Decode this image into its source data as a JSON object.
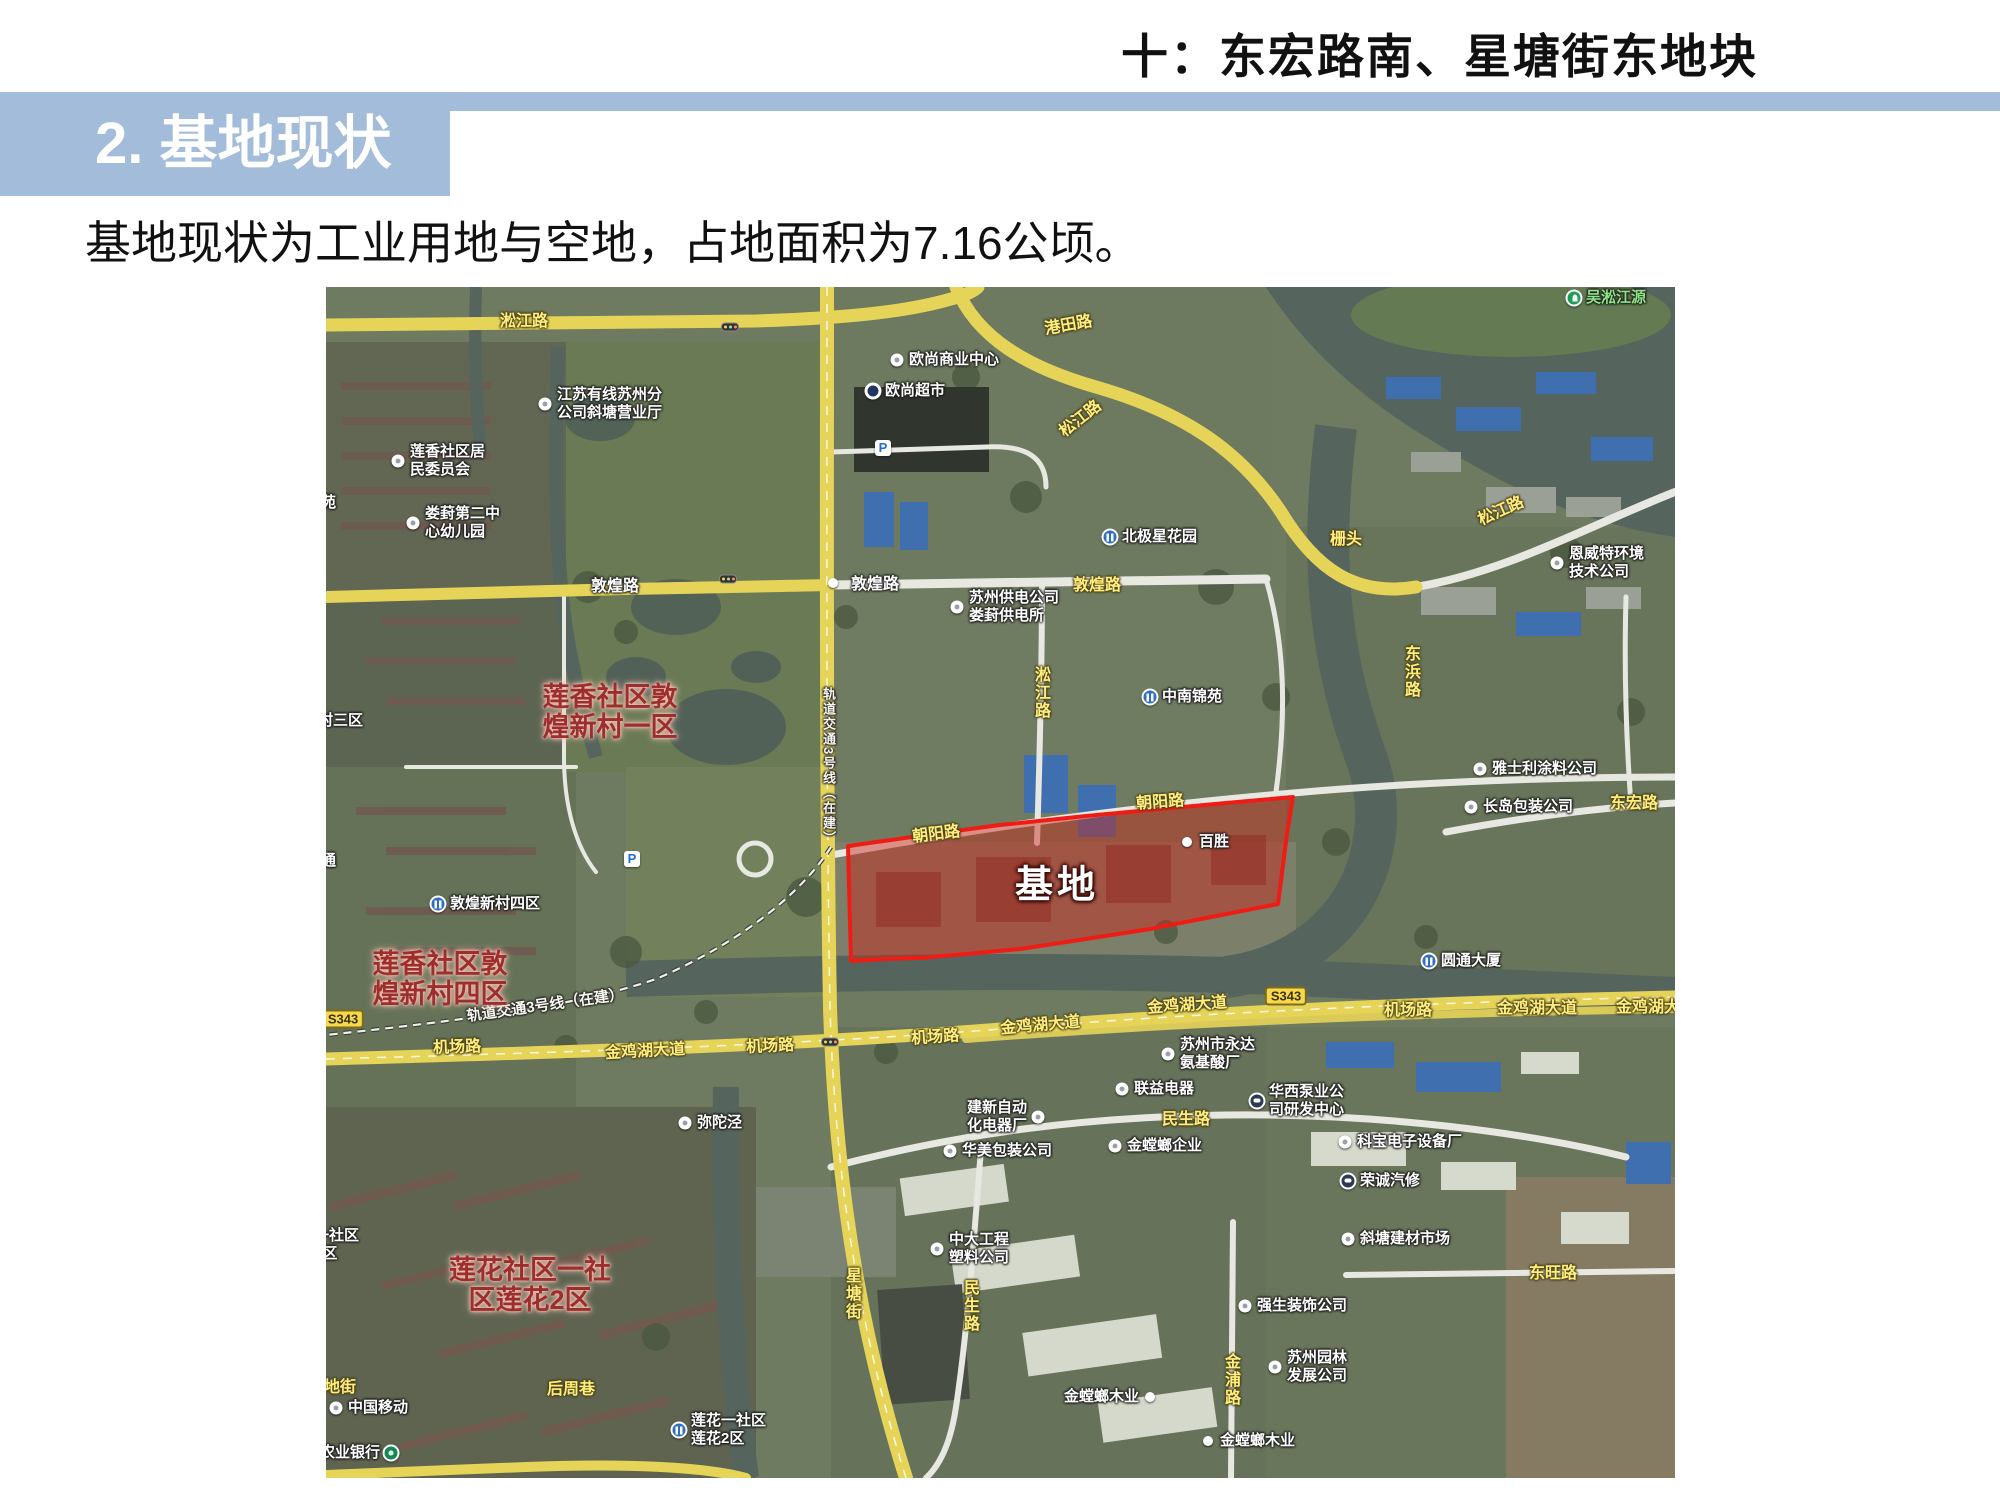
{
  "page": {
    "header_title": "十：东宏路南、星塘街东地块",
    "section_title": "2. 基地现状",
    "body_text": "基地现状为工业用地与空地，占地面积为7.16公顷。"
  },
  "colors": {
    "header_blue": "#a2bcd9",
    "site_outline_red": "#ee1c14",
    "site_fill_red": "rgba(205,35,25,0.45)",
    "road_yellow": "#e6d459",
    "label_yellow": "#ffee7d",
    "water": "#55645c",
    "land": "#6e7b60"
  },
  "map": {
    "site_label": {
      "text": "基地",
      "x": 731,
      "y": 594
    },
    "area_labels": [
      {
        "lines": [
          "莲香社区敦",
          "煌新村一区"
        ],
        "x": 284,
        "y": 425
      },
      {
        "lines": [
          "莲香社区敦",
          "煌新村四区"
        ],
        "x": 114,
        "y": 692
      },
      {
        "lines": [
          "莲花社区一社",
          "区莲花2区"
        ],
        "x": 204,
        "y": 998
      }
    ],
    "road_labels": [
      {
        "text": "淞江路",
        "x": 198,
        "y": 32,
        "style": "yellow",
        "rot": 0
      },
      {
        "text": "港田路",
        "x": 742,
        "y": 36,
        "style": "yellow",
        "rot": -10
      },
      {
        "text": "松江路",
        "x": 753,
        "y": 130,
        "style": "yellow",
        "rot": -38
      },
      {
        "text": "松江路",
        "x": 1174,
        "y": 222,
        "style": "yellow",
        "rot": -24
      },
      {
        "text": "淞江路",
        "x": 714,
        "y": 406,
        "style": "yellow",
        "vertical": true
      },
      {
        "text": "东浜路",
        "x": 1084,
        "y": 385,
        "style": "yellow",
        "vertical": true
      },
      {
        "text": "敦煌路",
        "x": 289,
        "y": 297,
        "style": "white",
        "rot": 0
      },
      {
        "text": "敦煌路",
        "x": 549,
        "y": 295,
        "style": "white",
        "rot": 0
      },
      {
        "text": "敦煌路",
        "x": 771,
        "y": 296,
        "style": "yellow",
        "rot": 0
      },
      {
        "text": "朝阳路",
        "x": 610,
        "y": 545,
        "style": "yellow",
        "rot": -7
      },
      {
        "text": "朝阳路",
        "x": 834,
        "y": 513,
        "style": "yellow",
        "rot": -4
      },
      {
        "text": "东宏路",
        "x": 1308,
        "y": 514,
        "style": "yellow",
        "rot": 0
      },
      {
        "text": "民生路",
        "x": 860,
        "y": 830,
        "style": "yellow",
        "rot": 0
      },
      {
        "text": "民生路",
        "x": 643,
        "y": 1019,
        "style": "yellow",
        "vertical": true
      },
      {
        "text": "金浦路",
        "x": 904,
        "y": 1093,
        "style": "yellow",
        "vertical": true
      },
      {
        "text": "星塘街",
        "x": 525,
        "y": 1007,
        "style": "yellow",
        "vertical": true
      },
      {
        "text": "东旺路",
        "x": 1227,
        "y": 984,
        "style": "yellow",
        "rot": 0
      },
      {
        "text": "机场路",
        "x": 131,
        "y": 758,
        "style": "yellow",
        "rot": -2
      },
      {
        "text": "金鸡湖大道",
        "x": 319,
        "y": 762,
        "style": "yellow",
        "rot": -3
      },
      {
        "text": "机场路",
        "x": 444,
        "y": 757,
        "style": "yellow",
        "rot": -3
      },
      {
        "text": "机场路",
        "x": 609,
        "y": 748,
        "style": "yellow",
        "rot": -4
      },
      {
        "text": "金鸡湖大道",
        "x": 714,
        "y": 736,
        "style": "yellow",
        "rot": -5
      },
      {
        "text": "金鸡湖大道",
        "x": 861,
        "y": 716,
        "style": "yellow",
        "rot": -4
      },
      {
        "text": "机场路",
        "x": 1082,
        "y": 721,
        "style": "yellow",
        "rot": 0
      },
      {
        "text": "金鸡湖大道",
        "x": 1211,
        "y": 719,
        "style": "yellow",
        "rot": 0
      },
      {
        "text": "金鸡湖大道",
        "x": 1330,
        "y": 718,
        "style": "yellow",
        "rot": 0
      },
      {
        "text": "后周巷",
        "x": 245,
        "y": 1100,
        "style": "yellow",
        "rot": 0
      },
      {
        "text": "地街",
        "x": 14,
        "y": 1098,
        "style": "yellow",
        "rot": 0
      },
      {
        "text": "栅头",
        "x": 1020,
        "y": 250,
        "style": "yellow",
        "rot": 0
      }
    ],
    "shields": [
      {
        "text": "S343",
        "x": 17,
        "y": 732
      },
      {
        "text": "S343",
        "x": 960,
        "y": 709
      }
    ],
    "metro_labels": [
      {
        "text": "轨道交通3号线（在建）",
        "x": 250,
        "y": 716,
        "rot": -8,
        "vertical": false
      },
      {
        "text": "轨道交通3号线（在建）",
        "x": 501,
        "y": 490,
        "rot": 0,
        "vertical": true
      }
    ],
    "poi_labels": [
      {
        "lines": [
          "江苏有线苏州分",
          "公司斜塘营业厅"
        ],
        "x": 219,
        "y": 117,
        "icon": "dot"
      },
      {
        "lines": [
          "莲香社区居",
          "民委员会"
        ],
        "x": 72,
        "y": 174,
        "icon": "dot"
      },
      {
        "lines": [
          "娄葑第二中",
          "心幼儿园"
        ],
        "x": 87,
        "y": 236,
        "icon": "dot"
      },
      {
        "lines": [
          "欧尚商业中心"
        ],
        "x": 571,
        "y": 73,
        "icon": "dot"
      },
      {
        "lines": [
          "欧尚超市"
        ],
        "x": 547,
        "y": 104,
        "icon": "auchan"
      },
      {
        "lines": [
          "吴淞江源"
        ],
        "x": 1248,
        "y": 11,
        "icon": "park",
        "green": true
      },
      {
        "lines": [
          "恩威特环境",
          "技术公司"
        ],
        "x": 1231,
        "y": 276,
        "icon": "dot"
      },
      {
        "lines": [
          "北极星花园"
        ],
        "x": 784,
        "y": 250,
        "icon": "building"
      },
      {
        "lines": [
          "中南锦苑"
        ],
        "x": 824,
        "y": 410,
        "icon": "building"
      },
      {
        "lines": [
          "苏州供电公司",
          "娄葑供电所"
        ],
        "x": 631,
        "y": 320,
        "icon": "dot"
      },
      {
        "lines": [
          "百胜"
        ],
        "x": 861,
        "y": 555,
        "icon": "smalldot"
      },
      {
        "lines": [
          "雅士利涂料公司"
        ],
        "x": 1154,
        "y": 482,
        "icon": "dot"
      },
      {
        "lines": [
          "长岛包装公司"
        ],
        "x": 1145,
        "y": 520,
        "icon": "dot"
      },
      {
        "lines": [
          "圆通大厦"
        ],
        "x": 1103,
        "y": 674,
        "icon": "building"
      },
      {
        "lines": [
          "苏州市永达",
          "氨基酸厂"
        ],
        "x": 842,
        "y": 767,
        "icon": "dot"
      },
      {
        "lines": [
          "联益电器"
        ],
        "x": 796,
        "y": 802,
        "icon": "dot"
      },
      {
        "lines": [
          "建新自动",
          "化电器厂"
        ],
        "x": 712,
        "y": 830,
        "icon": "dot",
        "side": "left"
      },
      {
        "lines": [
          "华西泵业公",
          "司研发中心"
        ],
        "x": 931,
        "y": 814,
        "icon": "bus"
      },
      {
        "lines": [
          "华美包装公司"
        ],
        "x": 624,
        "y": 864,
        "icon": "dot"
      },
      {
        "lines": [
          "金螳螂企业"
        ],
        "x": 789,
        "y": 859,
        "icon": "dot"
      },
      {
        "lines": [
          "科宝电子设备厂"
        ],
        "x": 1019,
        "y": 855,
        "icon": "dot"
      },
      {
        "lines": [
          "荣诚汽修"
        ],
        "x": 1022,
        "y": 894,
        "icon": "bus"
      },
      {
        "lines": [
          "中大工程",
          "塑料公司"
        ],
        "x": 611,
        "y": 962,
        "icon": "dot"
      },
      {
        "lines": [
          "斜塘建材市场"
        ],
        "x": 1022,
        "y": 952,
        "icon": "dot"
      },
      {
        "lines": [
          "强生装饰公司"
        ],
        "x": 919,
        "y": 1019,
        "icon": "dot"
      },
      {
        "lines": [
          "苏州园林",
          "发展公司"
        ],
        "x": 949,
        "y": 1080,
        "icon": "dot"
      },
      {
        "lines": [
          "金螳螂木业"
        ],
        "x": 824,
        "y": 1110,
        "icon": "smalldot",
        "side": "left"
      },
      {
        "lines": [
          "金螳螂木业"
        ],
        "x": 882,
        "y": 1154,
        "icon": "smalldot"
      },
      {
        "lines": [
          "弥陀泾"
        ],
        "x": 359,
        "y": 836,
        "icon": "dot"
      },
      {
        "lines": [
          "中国移动"
        ],
        "x": 10,
        "y": 1121,
        "icon": "dot"
      },
      {
        "lines": [
          "农业银行"
        ],
        "x": 65,
        "y": 1166,
        "icon": "bank",
        "side": "left"
      },
      {
        "lines": [
          "莲花一社区",
          "莲花2区"
        ],
        "x": 353,
        "y": 1143,
        "icon": "building"
      },
      {
        "lines": [
          "敦煌新村四区"
        ],
        "x": 112,
        "y": 617,
        "icon": "building"
      }
    ],
    "edge_labels": [
      {
        "lines": [
          "田苑"
        ],
        "x": -20,
        "y": 216
      },
      {
        "lines": [
          "村三区"
        ],
        "x": -8,
        "y": 434
      },
      {
        "lines": [
          "通"
        ],
        "x": -5,
        "y": 574
      },
      {
        "lines": [
          "一社区",
          "4区"
        ],
        "x": -12,
        "y": 958
      }
    ],
    "traffic_lights": [
      {
        "x": 404,
        "y": 40
      },
      {
        "x": 402,
        "y": 292
      },
      {
        "x": 504,
        "y": 755
      }
    ],
    "parking_icons": [
      {
        "x": 557,
        "y": 161
      },
      {
        "x": 306,
        "y": 572
      }
    ],
    "plain_dots": [
      {
        "x": 507,
        "y": 296
      }
    ]
  }
}
